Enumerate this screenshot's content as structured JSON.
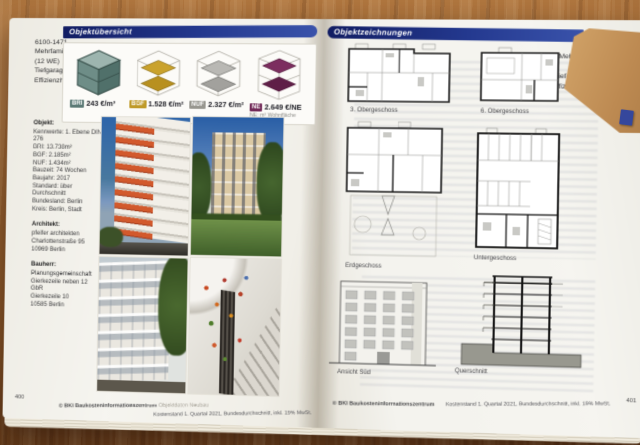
{
  "colors": {
    "banner_blue": "#1d2f7c",
    "kpi_bri": "#5c7a76",
    "kpi_bgf": "#bf9a28",
    "kpi_nuf": "#97968f",
    "kpi_ne": "#722a58",
    "kraft_paper": "#bd8a52",
    "wood_desk": "#9a6233",
    "page_tab_blue": "#35479c"
  },
  "left_page": {
    "margin_header": {
      "line1": "6100-1471",
      "line2": "Mehrfamilienhaus",
      "line3": "(12 WE)",
      "line4": "Tiefgarage (9 STP)",
      "line5": "Effizienzhaus ~60%"
    },
    "banner": "Objektübersicht",
    "kpis": [
      {
        "code": "BRI",
        "value": "243 €/m³",
        "color": "#5c7a76"
      },
      {
        "code": "BGF",
        "value": "1.528 €/m²",
        "color": "#bf9a28"
      },
      {
        "code": "NUF",
        "value": "2.327 €/m²",
        "color": "#97968f"
      },
      {
        "code": "NE",
        "value": "2.649 €/NE",
        "note": "NE: m² Wohnfläche",
        "color": "#722a58"
      }
    ],
    "objekt": {
      "title": "Objekt:",
      "lines": [
        "Kennwerte: 1. Ebene DIN 276",
        "BRI: 13.738m³",
        "BGF: 2.185m²",
        "NUF: 1.434m²",
        "Bauzeit: 74 Wochen",
        "Baujahr: 2017",
        "Standard: über Durchschnitt",
        "Bundesland: Berlin",
        "Kreis: Berlin, Stadt"
      ]
    },
    "architekt": {
      "title": "Architekt:",
      "lines": [
        "pfeifer architekten",
        "Charlottenstraße 95",
        "10969 Berlin"
      ]
    },
    "bauherr": {
      "title": "Bauherr:",
      "lines": [
        "Planungsgemeinschaft",
        "Gierkezeile neben 12 GbR",
        "Gierkezeile 10",
        "10585 Berlin"
      ]
    },
    "photos": [
      {
        "name": "street-facade-with-orange-awnings"
      },
      {
        "name": "garden-facade-with-lawn-and-trees"
      },
      {
        "name": "white-residential-facade-with-tree"
      },
      {
        "name": "staircase-with-colorful-wall-decals"
      }
    ],
    "footer": {
      "page_number": "400",
      "copyright": "© BKI Baukosteninformationszentrum",
      "copyright_gray": "Objektdaten Neubau",
      "kostenstand": "Kostenstand 1. Quartal 2021, Bundesdurchschnitt, inkl. 19% MwSt."
    }
  },
  "right_page": {
    "banner": "Objektzeichnungen",
    "margin_header": {
      "line1": "6100-1471",
      "line2": "Mehrfamilienhaus",
      "line3": "(12 WE)",
      "line4": "Tiefgarage (9 STP)",
      "line5": "Effizienzhaus ~60%"
    },
    "plans": [
      {
        "label": "3. Obergeschoss"
      },
      {
        "label": "6. Obergeschoss"
      },
      {
        "label": "Erdgeschoss"
      },
      {
        "label": "Untergeschoss"
      },
      {
        "label": "Ansicht Süd"
      },
      {
        "label": "Querschnitt"
      }
    ],
    "footer": {
      "copyright": "© BKI Baukosteninformationszentrum",
      "kostenstand": "Kostenstand 1. Quartal 2021, Bundesdurchschnitt, inkl. 19% MwSt.",
      "page_number": "401"
    }
  }
}
